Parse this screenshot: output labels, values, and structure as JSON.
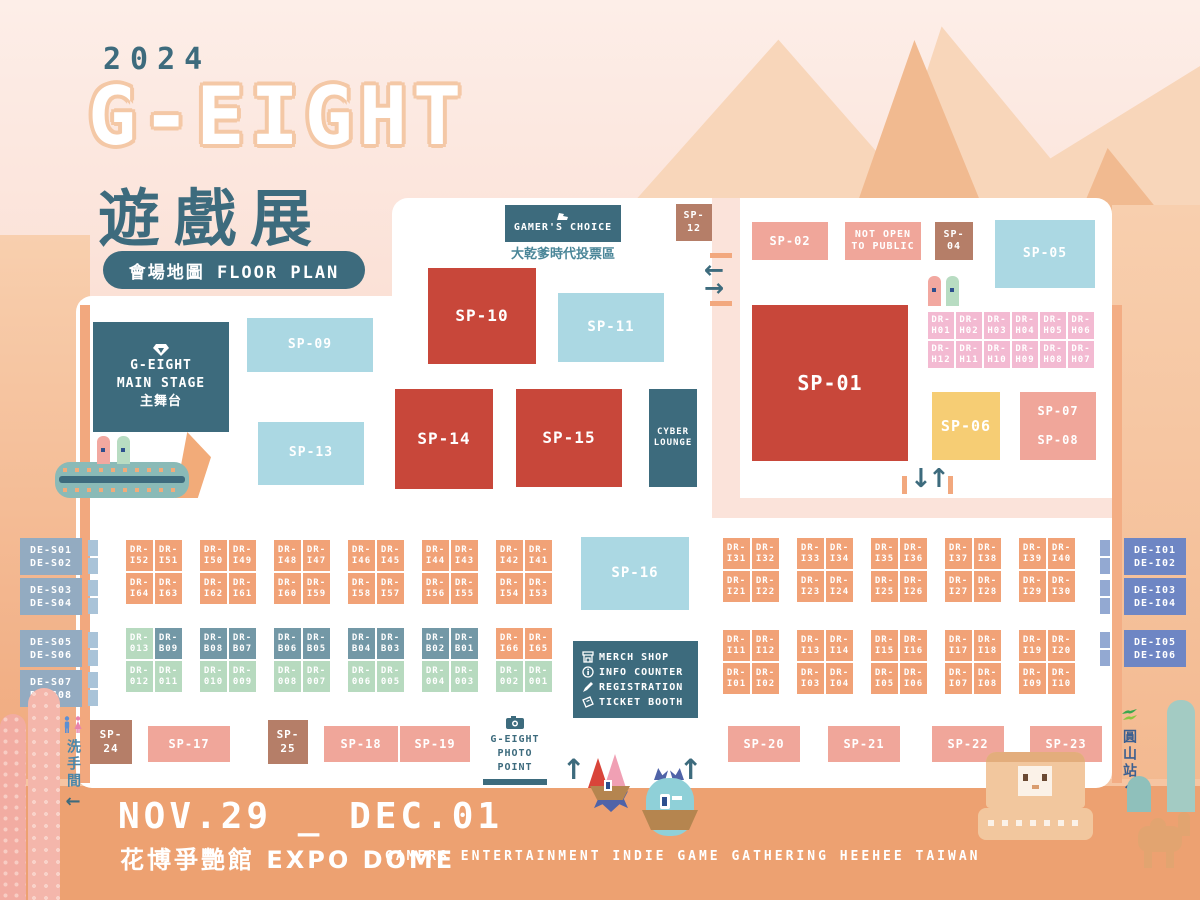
{
  "title": {
    "year": "2024",
    "logo": "G-EIGHT",
    "logo_cn": "遊戲展",
    "badge": "會場地圖 FLOOR PLAN"
  },
  "footer": {
    "dates": "NOV.29 _ DEC.01",
    "venue": "花博爭艷館 EXPO DOME",
    "tagline": "GAMERS  ENTERTAINMENT  INDIE  GAME  GATHERING  HEEHEE  TAIWAN"
  },
  "areas": {
    "gamers_choice": {
      "label": "GAMER'S CHOICE",
      "subtitle": "大乾爹時代投票區"
    },
    "main_stage": {
      "line1": "G-EIGHT",
      "line2": "MAIN STAGE",
      "line3": "主舞台"
    },
    "cyber_lounge": {
      "line1": "CYBER",
      "line2": "LOUNGE"
    },
    "not_open": {
      "line1": "NOT OPEN",
      "line2": "TO PUBLIC"
    },
    "photo_point": {
      "line1": "G-EIGHT",
      "line2": "PHOTO POINT"
    },
    "restroom": "洗手間",
    "station": "圓山站"
  },
  "legend": {
    "items": [
      {
        "icon": "merch-shop-icon",
        "label": "MERCH SHOP"
      },
      {
        "icon": "info-icon",
        "label": "INFO COUNTER"
      },
      {
        "icon": "pencil-icon",
        "label": "REGISTRATION"
      },
      {
        "icon": "ticket-icon",
        "label": "TICKET BOOTH"
      }
    ]
  },
  "icons": {
    "left_arrow": "←",
    "right_arrow": "→",
    "up_arrow": "↑",
    "down_arrow": "↓"
  },
  "sp": {
    "s01": "SP-01",
    "s02": "SP-02",
    "s04": "SP-04",
    "s05": "SP-05",
    "s06": "SP-06",
    "s07": "SP-07",
    "s08": "SP-08",
    "s09": "SP-09",
    "s10": "SP-10",
    "s11": "SP-11",
    "s12": "SP-12",
    "s13": "SP-13",
    "s14": "SP-14",
    "s15": "SP-15",
    "s16": "SP-16",
    "s17": "SP-17",
    "s18": "SP-18",
    "s19": "SP-19",
    "s20": "SP-20",
    "s21": "SP-21",
    "s22": "SP-22",
    "s23": "SP-23",
    "s24": "SP-24",
    "s25": "SP-25"
  },
  "de": {
    "left": [
      [
        "DE-S01",
        "DE-S02"
      ],
      [
        "DE-S03",
        "DE-S04"
      ],
      [
        "DE-S05",
        "DE-S06"
      ],
      [
        "DE-S07",
        "DE-S08"
      ]
    ],
    "right": [
      [
        "DE-I01",
        "DE-I02"
      ],
      [
        "DE-I03",
        "DE-I04"
      ],
      [
        "DE-I05",
        "DE-I06"
      ]
    ]
  },
  "dr_h": [
    [
      "DR-H01",
      "DR-H02",
      "DR-H03",
      "DR-H04",
      "DR-H05",
      "DR-H06"
    ],
    [
      "DR-H12",
      "DR-H11",
      "DR-H10",
      "DR-H09",
      "DR-H08",
      "DR-H07"
    ]
  ],
  "dr_left_top": [
    {
      "top": [
        "DR-I52",
        "DR-I51"
      ],
      "bottom": [
        "DR-I64",
        "DR-I63"
      ]
    },
    {
      "top": [
        "DR-I50",
        "DR-I49"
      ],
      "bottom": [
        "DR-I62",
        "DR-I61"
      ]
    },
    {
      "top": [
        "DR-I48",
        "DR-I47"
      ],
      "bottom": [
        "DR-I60",
        "DR-I59"
      ]
    },
    {
      "top": [
        "DR-I46",
        "DR-I45"
      ],
      "bottom": [
        "DR-I58",
        "DR-I57"
      ]
    },
    {
      "top": [
        "DR-I44",
        "DR-I43"
      ],
      "bottom": [
        "DR-I56",
        "DR-I55"
      ]
    },
    {
      "top": [
        "DR-I42",
        "DR-I41"
      ],
      "bottom": [
        "DR-I54",
        "DR-I53"
      ]
    }
  ],
  "dr_left_bottom": [
    {
      "top": [
        {
          "t": "DR-013",
          "c": "green"
        },
        {
          "t": "DR-B09",
          "c": "slate"
        }
      ],
      "bottom": [
        {
          "t": "DR-012",
          "c": "green"
        },
        {
          "t": "DR-011",
          "c": "green"
        }
      ]
    },
    {
      "top": [
        {
          "t": "DR-B08",
          "c": "slate"
        },
        {
          "t": "DR-B07",
          "c": "slate"
        }
      ],
      "bottom": [
        {
          "t": "DR-010",
          "c": "green"
        },
        {
          "t": "DR-009",
          "c": "green"
        }
      ]
    },
    {
      "top": [
        {
          "t": "DR-B06",
          "c": "slate"
        },
        {
          "t": "DR-B05",
          "c": "slate"
        }
      ],
      "bottom": [
        {
          "t": "DR-008",
          "c": "green"
        },
        {
          "t": "DR-007",
          "c": "green"
        }
      ]
    },
    {
      "top": [
        {
          "t": "DR-B04",
          "c": "slate"
        },
        {
          "t": "DR-B03",
          "c": "slate"
        }
      ],
      "bottom": [
        {
          "t": "DR-006",
          "c": "green"
        },
        {
          "t": "DR-005",
          "c": "green"
        }
      ]
    },
    {
      "top": [
        {
          "t": "DR-B02",
          "c": "slate"
        },
        {
          "t": "DR-B01",
          "c": "slate"
        }
      ],
      "bottom": [
        {
          "t": "DR-004",
          "c": "green"
        },
        {
          "t": "DR-003",
          "c": "green"
        }
      ]
    },
    {
      "top": [
        {
          "t": "DR-I66",
          "c": "orange"
        },
        {
          "t": "DR-I65",
          "c": "orange"
        }
      ],
      "bottom": [
        {
          "t": "DR-002",
          "c": "green"
        },
        {
          "t": "DR-001",
          "c": "green"
        }
      ]
    }
  ],
  "dr_right_top": [
    {
      "top": [
        "DR-I31",
        "DR-I32"
      ],
      "bottom": [
        "DR-I21",
        "DR-I22"
      ]
    },
    {
      "top": [
        "DR-I33",
        "DR-I34"
      ],
      "bottom": [
        "DR-I23",
        "DR-I24"
      ]
    },
    {
      "top": [
        "DR-I35",
        "DR-I36"
      ],
      "bottom": [
        "DR-I25",
        "DR-I26"
      ]
    },
    {
      "top": [
        "DR-I37",
        "DR-I38"
      ],
      "bottom": [
        "DR-I27",
        "DR-I28"
      ]
    },
    {
      "top": [
        "DR-I39",
        "DR-I40"
      ],
      "bottom": [
        "DR-I29",
        "DR-I30"
      ]
    }
  ],
  "dr_right_bottom": [
    {
      "top": [
        "DR-I11",
        "DR-I12"
      ],
      "bottom": [
        "DR-I01",
        "DR-I02"
      ]
    },
    {
      "top": [
        "DR-I13",
        "DR-I14"
      ],
      "bottom": [
        "DR-I03",
        "DR-I04"
      ]
    },
    {
      "top": [
        "DR-I15",
        "DR-I16"
      ],
      "bottom": [
        "DR-I05",
        "DR-I06"
      ]
    },
    {
      "top": [
        "DR-I17",
        "DR-I18"
      ],
      "bottom": [
        "DR-I07",
        "DR-I08"
      ]
    },
    {
      "top": [
        "DR-I19",
        "DR-I20"
      ],
      "bottom": [
        "DR-I09",
        "DR-I10"
      ]
    }
  ],
  "colors": {
    "teal": "#3d6b7d",
    "red": "#c8473a",
    "salmon": "#f0a69a",
    "brown": "#b57e68",
    "yellow": "#f6cd74",
    "lightblue": "#abd8e3",
    "orange_cell": "#f1a277",
    "pink_cell": "#f3bad2",
    "pink_text": "#cf7fa9",
    "green_cell": "#b7dabf",
    "slate_cell": "#7398a6",
    "de_left": "#93abc1",
    "de_right": "#6e86c4"
  }
}
